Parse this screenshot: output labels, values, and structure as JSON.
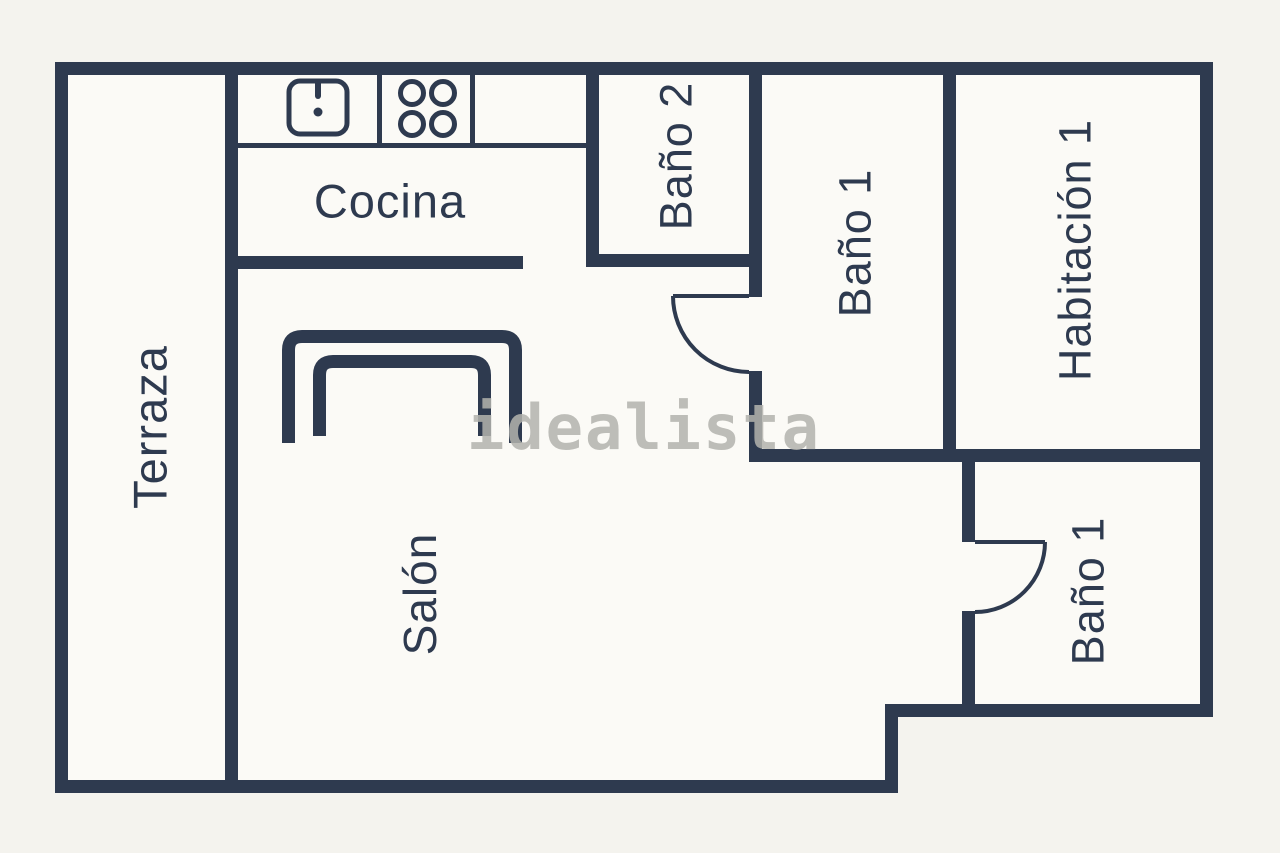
{
  "floorplan": {
    "watermark": {
      "text": "idealista",
      "color": "#b3b3ae"
    },
    "colors": {
      "wall": "#2e3a4f",
      "floor": "#fbfaf6",
      "background": "#f4f3ee",
      "label": "#2e3a4f"
    },
    "rooms": {
      "terraza": {
        "label": "Terraza"
      },
      "cocina": {
        "label": "Cocina"
      },
      "bano2": {
        "label": "Baño 2"
      },
      "bano1": {
        "label": "Baño 1"
      },
      "habitacion1": {
        "label": "Habitación 1"
      },
      "salon": {
        "label": "Salón"
      },
      "bano1b": {
        "label": "Baño 1"
      }
    },
    "icons": {
      "sink": "sink-icon",
      "stove": "stove-icon",
      "sofa": "sofa-icon",
      "door_upper": "door-arc-icon",
      "door_lower": "door-arc-icon"
    }
  }
}
